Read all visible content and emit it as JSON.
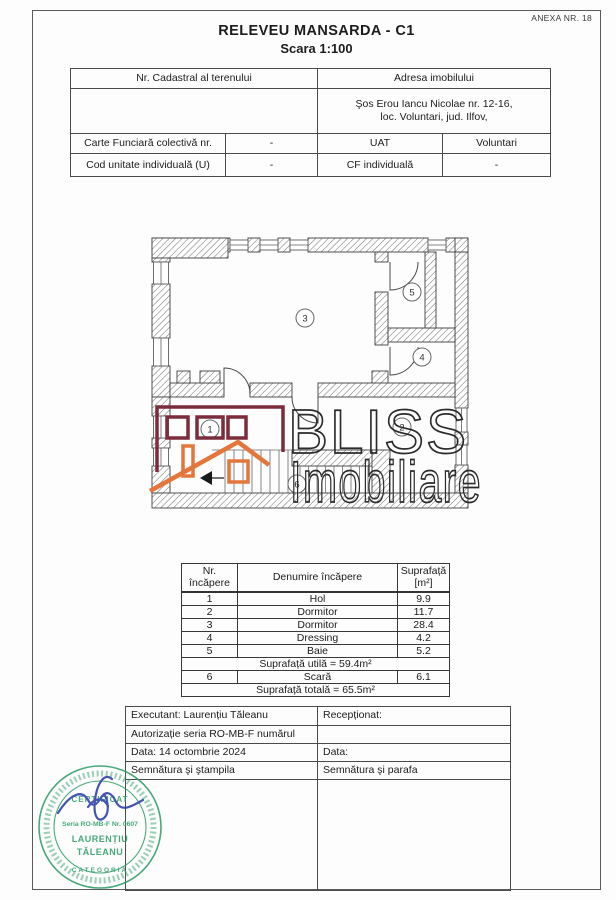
{
  "page": {
    "anexa": "ANEXA NR. 18",
    "title": "RELEVEU MANSARDA - C1",
    "scale": "Scara 1:100"
  },
  "cadastral_table": {
    "header_left": "Nr. Cadastral al terenului",
    "header_right": "Adresa imobilului",
    "nr_cadastral_value": "",
    "address_line1": "Şos Erou Iancu Nicolae nr. 12-16,",
    "address_line2": "loc. Voluntari, jud. Ilfov,",
    "row3": {
      "c1": "Carte Funciară colectivă nr.",
      "c2": "-",
      "c3": "UAT",
      "c4": "Voluntari"
    },
    "row4": {
      "c1": "Cod unitate individuală (U)",
      "c2": "-",
      "c3": "CF individuală",
      "c4": "-"
    }
  },
  "floor_plan": {
    "room_labels": [
      "1",
      "2",
      "3",
      "4",
      "5",
      "6"
    ],
    "watermark": {
      "line1": "BLISS",
      "line2": "Imobiliare",
      "text_color": "#2b2b2b",
      "logo_primary": "#7b2d3c",
      "logo_accent": "#e4763b"
    }
  },
  "area_table": {
    "header_col1": "Nr. încăpere",
    "header_col2": "Denumire încăpere",
    "header_col3_line1": "Suprafață",
    "header_col3_line2": "[m²]",
    "rows": [
      {
        "nr": "1",
        "name": "Hol",
        "area": "9.9"
      },
      {
        "nr": "2",
        "name": "Dormitor",
        "area": "11.7"
      },
      {
        "nr": "3",
        "name": "Dormitor",
        "area": "28.4"
      },
      {
        "nr": "4",
        "name": "Dressing",
        "area": "4.2"
      },
      {
        "nr": "5",
        "name": "Baie",
        "area": "5.2"
      }
    ],
    "useful_area_row": "Suprafață utilă = 59.4m²",
    "stair_row": {
      "nr": "6",
      "name": "Scară",
      "area": "6.1"
    },
    "total_area_row": "Suprafață totală = 65.5m²"
  },
  "footer_table": {
    "executant": "Executant: Laurențiu Tăleanu",
    "receptionat": "Recepționat:",
    "autorizatie": "Autorizație seria RO-MB-F numărul",
    "data_left": "Data: 14 octombrie 2024",
    "data_right": "Data:",
    "semnatura_left": "Semnătura şi ştampila",
    "semnatura_right": "Semnătura şi parafa"
  },
  "stamp": {
    "line1": "CERTIFICAT",
    "line2": "Seria RO-MB-F Nr. 0607",
    "name_line1": "LAURENȚIU",
    "name_line2": "TĂLEANU",
    "category": "CATEGORIA",
    "ink_color": "#2f9e68",
    "signature_color": "#2b3da8"
  }
}
